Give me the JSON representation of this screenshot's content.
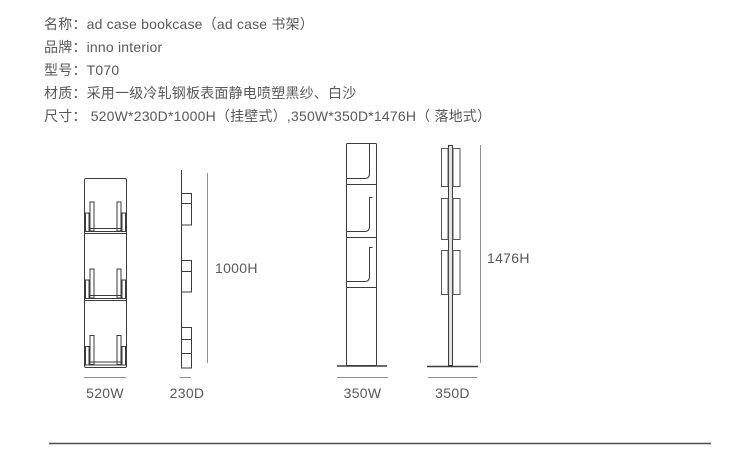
{
  "specs": {
    "lines": [
      "名称：ad case bookcase（ad case 书架）",
      "品牌：inno interior",
      "型号：T070",
      "材质：采用一级冷轧钢板表面静电喷塑黑纱、白沙",
      "尺寸： 520W*230D*1000H（挂壁式）,350W*350D*1476H（ 落地式）"
    ]
  },
  "drawings": {
    "wall_mount": {
      "front_width_label": "520W",
      "side_depth_label": "230D",
      "height_label": "1000H"
    },
    "floor_standing": {
      "front_width_label": "350W",
      "side_depth_label": "350D",
      "height_label": "1476H"
    }
  },
  "colors": {
    "text": "#58595b",
    "drawing_line": "#3b3b3b",
    "dimension_line": "#8f8f8f",
    "footer_rule": "#4d4d4d",
    "background": "#ffffff"
  }
}
